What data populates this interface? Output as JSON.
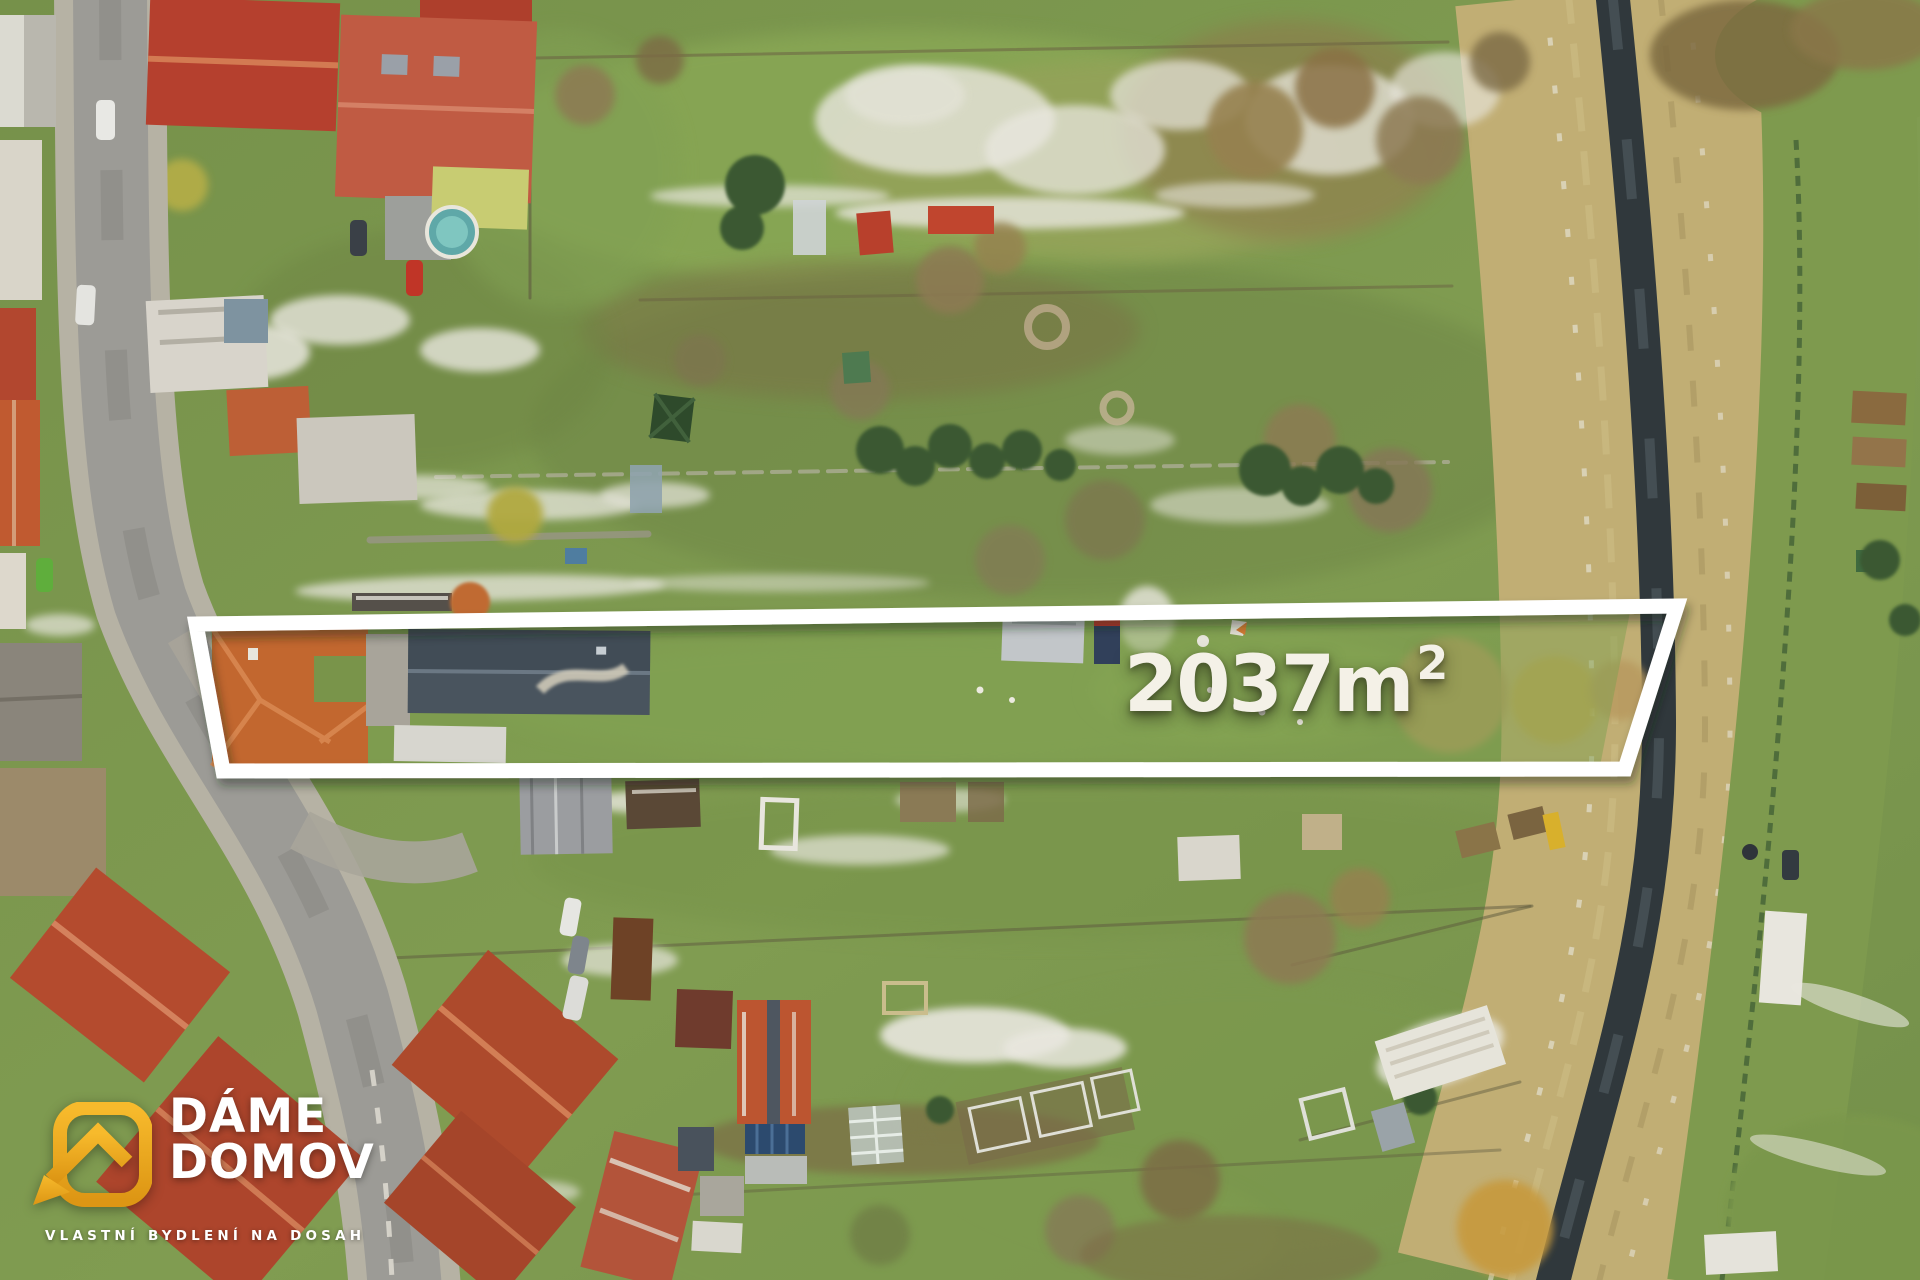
{
  "watermark": {
    "area_value": "2037m",
    "area_exponent": "2",
    "area_full": "2037m²",
    "text_color": "#F4F1E7",
    "outline_color": "#FFFFFF"
  },
  "logo": {
    "line1": "DÁME",
    "line2": "DOMOV",
    "tagline": "VLASTNÍ BYDLENÍ NA DOSAH",
    "icon": "rounded-square-house-icon",
    "gold": "#EFA91E",
    "text_color": "#FFFFFF"
  },
  "photo": {
    "palette": {
      "grass": "#7D9750",
      "straw_bank": "#C2B077",
      "stream_water": "#30383C",
      "road": "#9C9B96",
      "sidewalk": "#B6B2A4",
      "red_roof": "#B3462F",
      "orange_roof": "#C2672F",
      "slate_roof": "#49545E",
      "snow": "#E9E7DF",
      "conifer": "#3A5830",
      "bare_tree": "#8D7A52"
    }
  }
}
